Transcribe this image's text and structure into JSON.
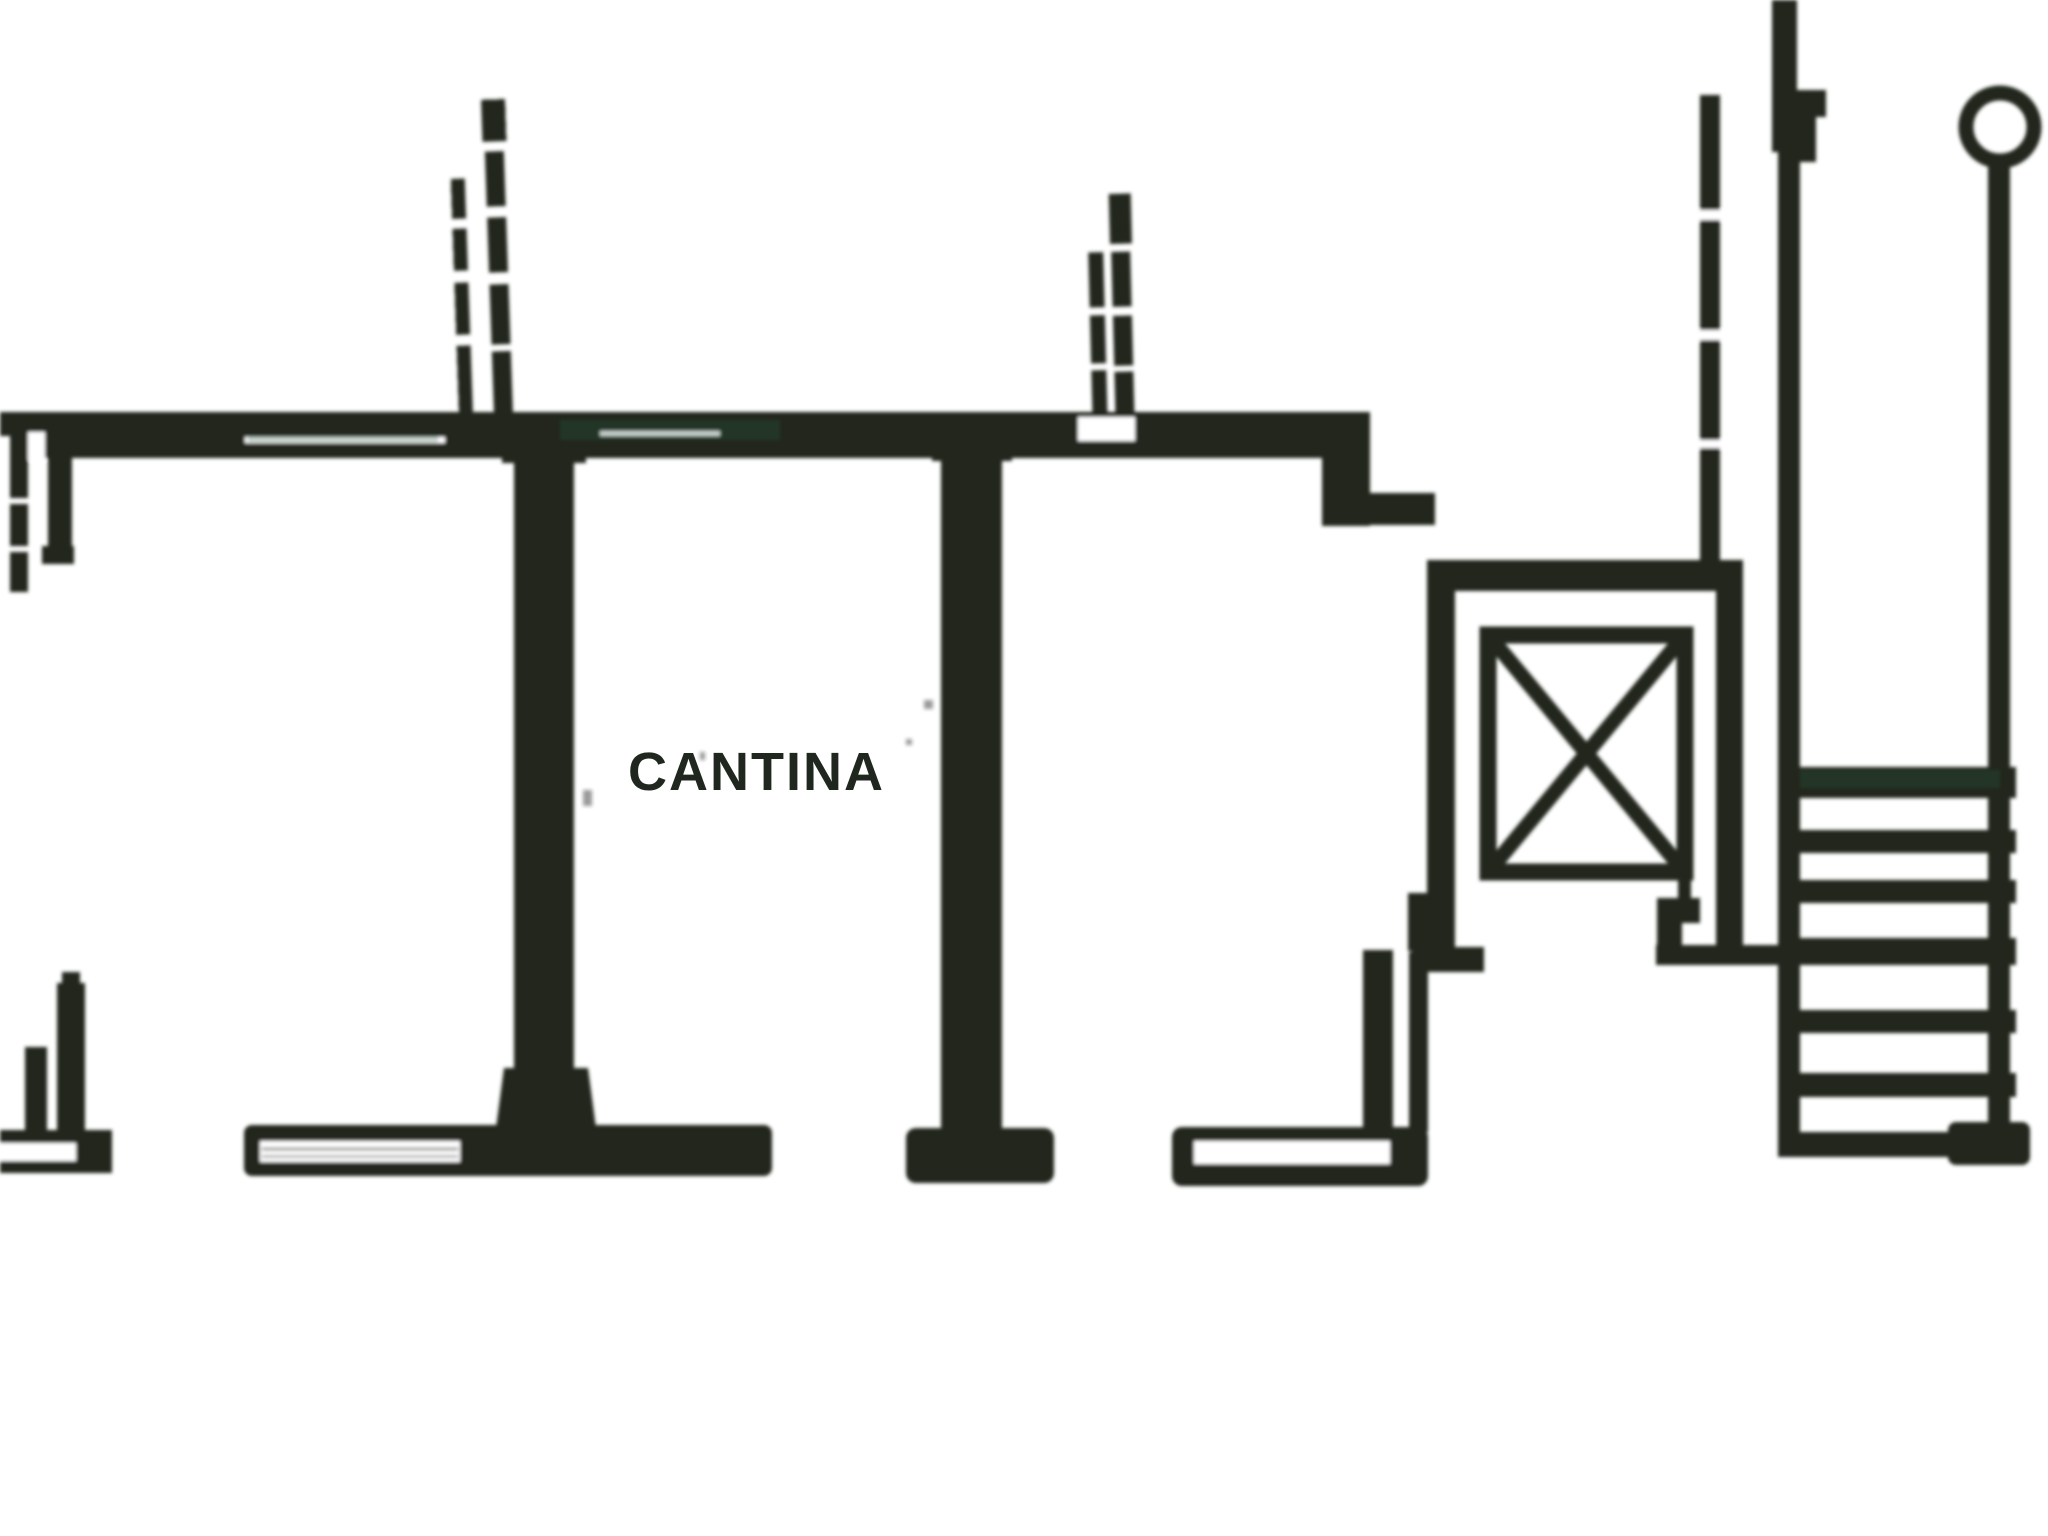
{
  "colors": {
    "ink": "#20271f",
    "paper": "#ffffff",
    "scan_tint": "#2f5a41"
  },
  "plan": {
    "room_label": "CANTINA",
    "symbols": {
      "elevator": "elevator-x-icon",
      "stairs": "stair-treads-icon",
      "newel": "newel-circle-icon"
    },
    "stairs_tread_count": 7
  }
}
